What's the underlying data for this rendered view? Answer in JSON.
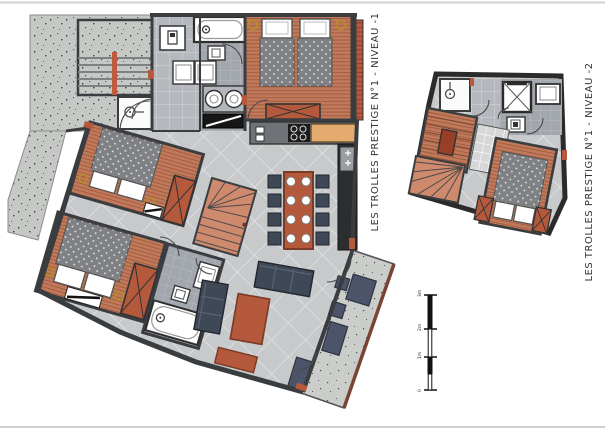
{
  "sheet": {
    "background": "#ffffff",
    "border_color": "#ccd1d5"
  },
  "plans": [
    {
      "id": "niveau-1",
      "title": "LES TROLLES PRESTIGE N°1 - NIVEAU -1"
    },
    {
      "id": "niveau-2",
      "title": "LES TROLLES PRESTIGE N°1 - NIVEAU -2"
    }
  ],
  "scale_bar": {
    "labels": [
      "3m",
      "2m",
      "1m",
      "0"
    ]
  },
  "colors": {
    "wall": "#3a3d40",
    "concrete": "#c6c8c6",
    "wood_floor": "#c07a5b",
    "wood_stripe": "#a55c40",
    "tile_floor": "#c7c9cb",
    "hall_tile": "#b5b9be",
    "bath_tile": "#a2a6ad",
    "furniture_terracotta": "#b5593c",
    "furniture_navy": "#3f4856",
    "counter_wood": "#e3ac6e",
    "appliance_dark": "#232323",
    "duvet_gray": "#7f8184",
    "lamp_gold": "#b5892f"
  }
}
